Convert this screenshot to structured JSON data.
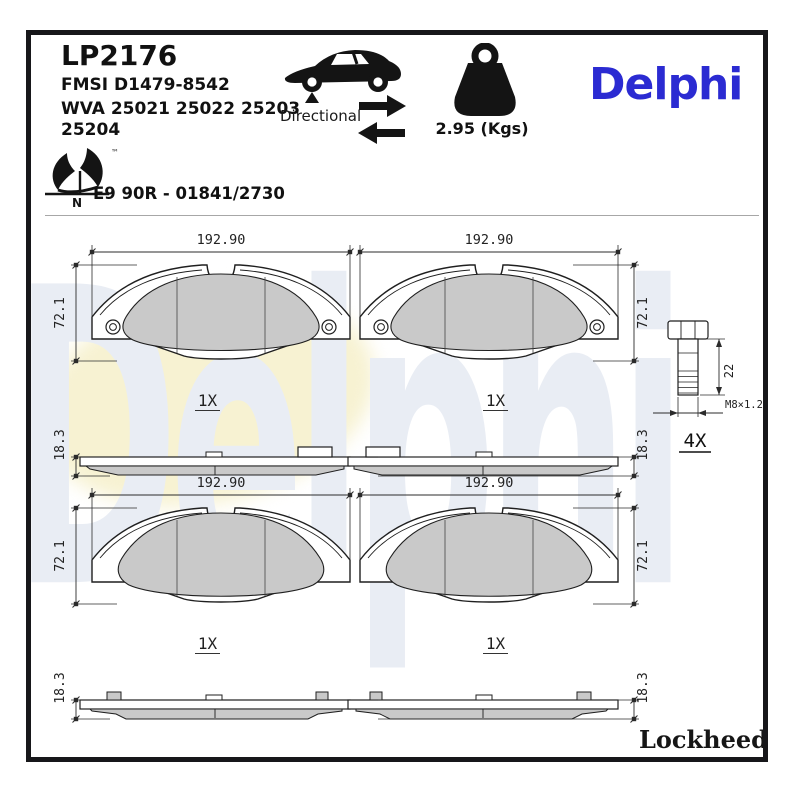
{
  "header": {
    "part_number": "LP2176",
    "fmsi": "FMSI D1479-8542",
    "wva_line1": "WVA 25021 25022 25203",
    "wva_line2": "25204",
    "directional_label": "Directional",
    "weight_label": "2.95 (Kgs)",
    "brand_logo": "Delphi",
    "eco_tm": "™",
    "eco_n": "N",
    "approval": "E9 90R - 01841/2730"
  },
  "drawings": {
    "pad_width": "192.90",
    "pad_height": "72.1",
    "pad_thickness": "18.3",
    "pad_qty": "1X",
    "bolt": {
      "shank_length": "22",
      "thread_spec": "M8×1.25",
      "qty": "4X"
    }
  },
  "footer": {
    "brand": "Lockheed",
    "reg": "®"
  },
  "watermark": "Delphi",
  "colors": {
    "brand_blue": "#2b2bd2",
    "friction_gray": "#c9c9c9",
    "watermark_gray": "#e9edf4",
    "watermark_yellow": "#f7f2d2",
    "line_black": "#1f1f1f"
  }
}
